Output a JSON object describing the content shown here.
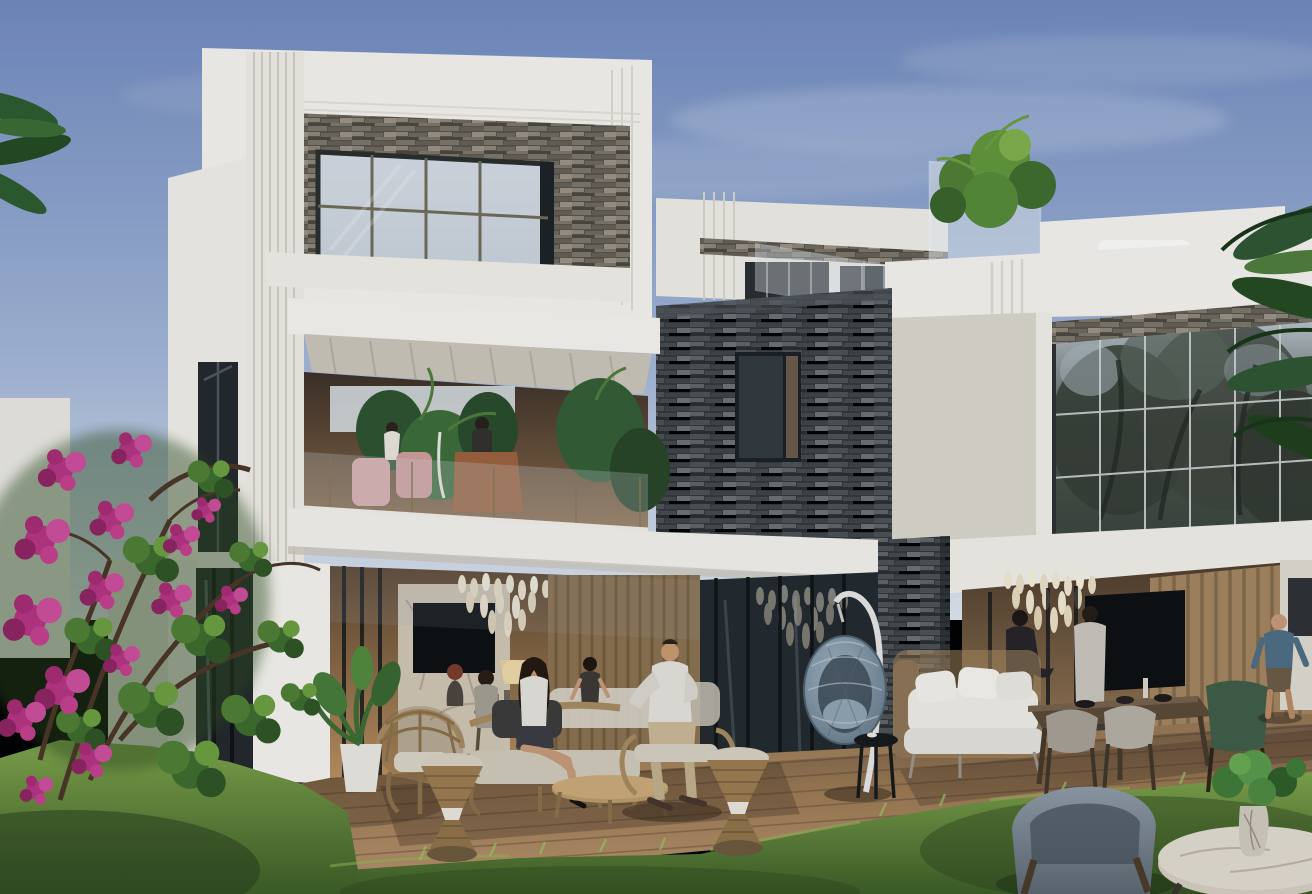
{
  "scene": {
    "type": "photorealistic architectural exterior rendering",
    "subject": "Modern two-storey white villa with stacked-stone accent walls, large glazed facades, roof terrace, open ground-floor lounge, wooden deck terrace with outdoor furniture, lawn and bougainvillea at golden hour under a dusk-blue sky",
    "text_content": "none — the image contains no visible text, UI elements or watermarks",
    "palette": {
      "sky_top": "#7089bd",
      "sky_mid": "#9fb2d4",
      "sky_horizon": "#dde3ec",
      "cloud": "#e9edf4",
      "wall_sunlit": "#f3f1eb",
      "wall_light": "#eceae4",
      "wall_shaded": "#d9d4cb",
      "slab_underside": "#c9c3b8",
      "stone_light_base": "#57524a",
      "stone_dark_base": "#33373a",
      "glass_pale": "#c9d0da",
      "glass_dark": "#22272b",
      "frame_dark": "#1d2124",
      "mullion_bronze": "#6e6b58",
      "mullion_light": "#cfd3d4",
      "glass_tree_reflection": "#49544a",
      "interior_warm_deep": "#5a432e",
      "interior_warm": "#b98e5e",
      "chandelier_glow": "#f0e7d2",
      "tv_screen": "#0d0f11",
      "marble_wall": "#cfc3b2",
      "wood_slat_wall": "#8a6f4e",
      "deck_light": "#b5906a",
      "deck_mid": "#9a7852",
      "deck_shadow": "#6e5742",
      "lawn_light": "#7da24a",
      "lawn_deep": "#3c5c25",
      "bougainvillea": "#b43380",
      "bougainvillea_light": "#cb4f9a",
      "bougainvillea_deep": "#8e2360",
      "leaf_green": "#3c6b2c",
      "leaf_bright": "#6b9c3e",
      "palm_green": "#2d5a2e",
      "rattan": "#a5895e",
      "cushion_white": "#eceae4",
      "egg_chair_light": "#9db0bf",
      "egg_chair_dark": "#5d6f7d",
      "egg_stand": "#e3e3e1",
      "armchair_blue_light": "#8e9aa6",
      "armchair_blue_dark": "#5c6670",
      "marble_table": "#d3ccbf",
      "wood_dark": "#5a4836",
      "chair_green": "#3e5c46",
      "pink_chair": "#d9a7a4",
      "leather_chair": "#9a5f3c",
      "skin": "#c69878",
      "shirt_white": "#e3e0d8",
      "shirt_blue": "#4e6d82",
      "outfit_dark": "#262328",
      "pants_khaki": "#c9b795"
    },
    "elements": [
      {
        "name": "sky",
        "desc": "dusk gradient sky with thin soft clouds"
      },
      {
        "name": "left-volume",
        "desc": "white framed upper box with stacked-stone recess and large bronze-mullion picture window"
      },
      {
        "name": "balcony",
        "desc": "first-floor loggia with glass balustrade, palms, pink chairs, leather chair and two figures"
      },
      {
        "name": "center-stone-wall",
        "desc": "dark stacked-stone block with small dark window"
      },
      {
        "name": "roof-terrace",
        "desc": "set-back volume with glass balustrade panels and planter greenery"
      },
      {
        "name": "right-volume",
        "desc": "white slab volume with full-height curtain wall reflecting trees"
      },
      {
        "name": "living-opening-left",
        "desc": "open lounge with marble TV wall, chandelier, lamp and glass sliders"
      },
      {
        "name": "living-opening-right",
        "desc": "open lounge with chandelier, wall TV, wood-slat wall and two standing men"
      },
      {
        "name": "stone-pillar",
        "desc": "ground-floor stacked-stone pier"
      },
      {
        "name": "deck-terrace",
        "desc": "wooden plank terrace"
      },
      {
        "name": "lawn",
        "desc": "sunlit lawn in foreground"
      },
      {
        "name": "bougainvillea",
        "desc": "magenta flowering bush, lower-left"
      },
      {
        "name": "palm-fronds",
        "desc": "palm leaves at upper-left and right edges"
      },
      {
        "name": "hanging-egg-chair",
        "desc": "grey woven egg chair on white stand with black side table"
      },
      {
        "name": "outdoor-lounge-set",
        "desc": "rattan daybed, armchairs, drum stools and low table with seated figures"
      },
      {
        "name": "white-sofa",
        "desc": "white cushioned outdoor sofa"
      },
      {
        "name": "dining-set",
        "desc": "dark wood dining table with grey and green chairs"
      },
      {
        "name": "blue-armchair",
        "desc": "blue-grey armchair on lawn, foreground"
      },
      {
        "name": "marble-coffee-table",
        "desc": "round marble table with potted plant, foreground right"
      },
      {
        "name": "people",
        "desc": "ten stylized figures: two on balcony, four women and one man seated on deck, two men indoors, one man in blue walking"
      }
    ]
  }
}
